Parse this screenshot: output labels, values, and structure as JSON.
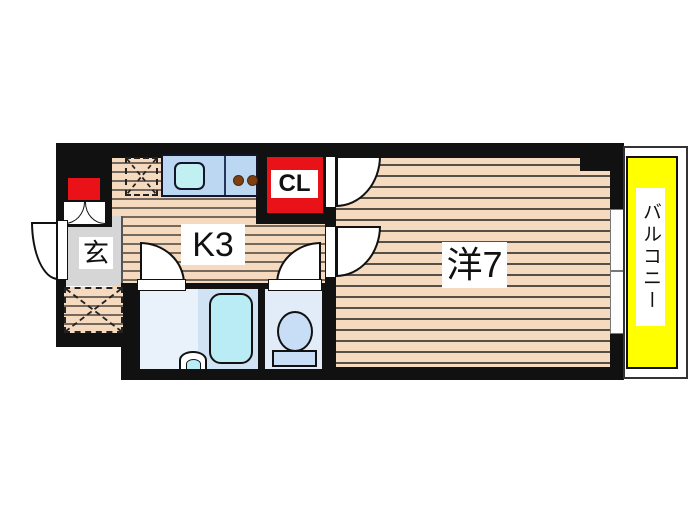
{
  "floorplan": {
    "rooms": {
      "entrance": {
        "label": "玄"
      },
      "kitchen": {
        "label": "K3"
      },
      "closet": {
        "label": "CL"
      },
      "western_room": {
        "label": "洋7"
      },
      "balcony": {
        "label": "バルコニー"
      }
    },
    "fixtures": [
      "kitchen-sink",
      "gas-burners",
      "kitchen-counter",
      "hatched-storage-top",
      "hatched-storage-bottom",
      "shoe-cabinet",
      "entrance-door",
      "bathtub",
      "wash-basin",
      "toilet",
      "bath-door",
      "toilet-door",
      "closet-door",
      "room-door",
      "sliding-window",
      "balcony-railing"
    ],
    "colors": {
      "wall": "#111111",
      "wood_floor": "#f5dabf",
      "wood_stripe": "#6e6055",
      "accent_red": "#ea1219",
      "balcony_yellow": "#ffff00",
      "entrance_gray": "#d6d6d6",
      "counter_blue": "#bcd7f2",
      "tub_cyan": "#b9ecf5",
      "bath_floor": "#e9f1fb",
      "toilet_fixture": "#c8def6"
    }
  }
}
